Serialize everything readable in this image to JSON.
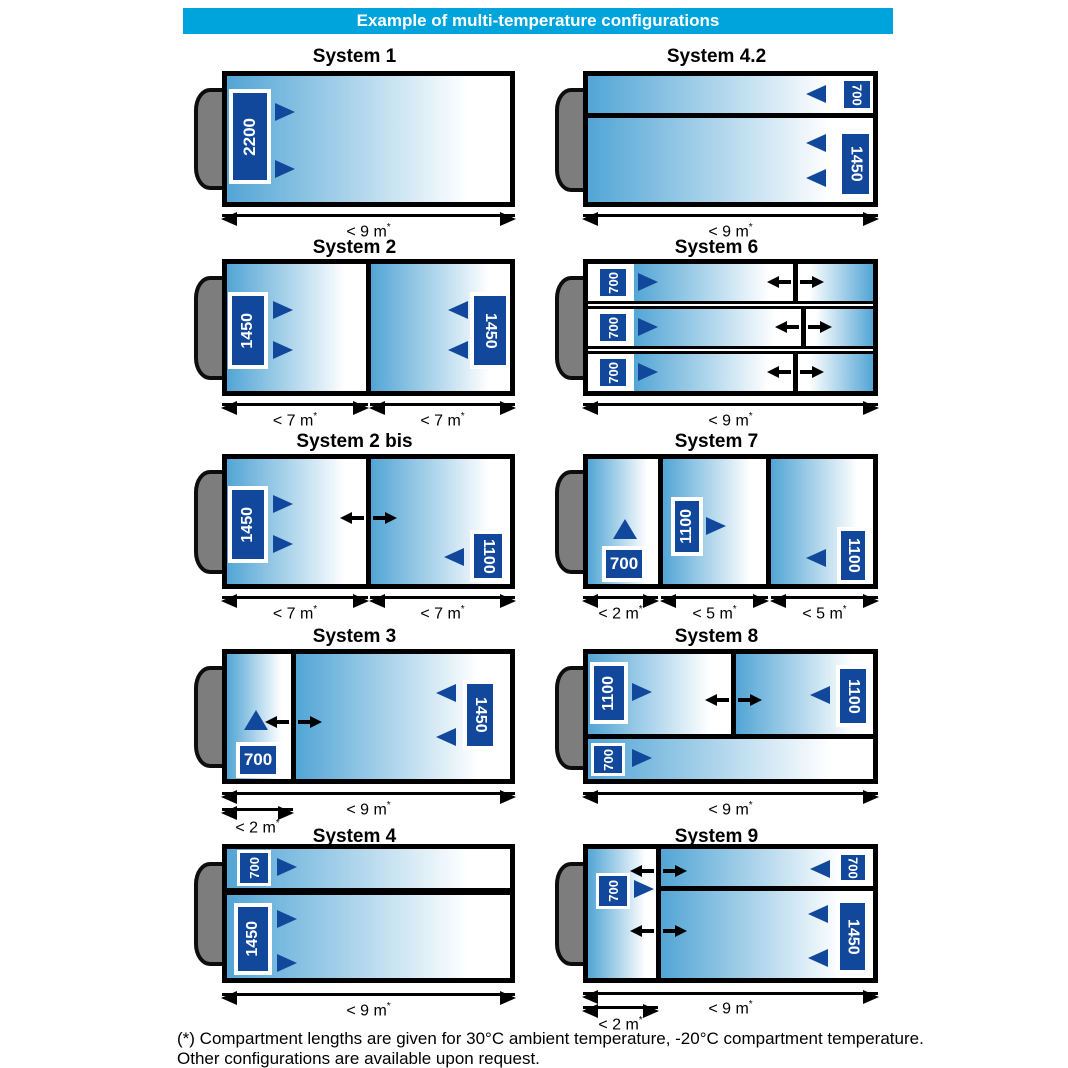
{
  "header": {
    "title": "Example of multi-temperature configurations"
  },
  "colors": {
    "header_bg": "#00a4dc",
    "unit_navy": "#11489c",
    "gradient_blue": "#52a5d5",
    "cab_gray": "#7d7d7d"
  },
  "systems": {
    "s1": {
      "title": "System 1",
      "unit": "2200",
      "dim": "< 9 m",
      "mark": "*"
    },
    "s42": {
      "title": "System 4.2",
      "unit_top": "700",
      "unit_bottom": "1450",
      "dim": "< 9 m",
      "mark": "*"
    },
    "s2": {
      "title": "System 2",
      "unit_left": "1450",
      "unit_right": "1450",
      "dim_left": "< 7 m",
      "dim_right": "< 7 m",
      "mark": "*"
    },
    "s6": {
      "title": "System 6",
      "unit_row1": "700",
      "unit_row2": "700",
      "unit_row3": "700",
      "dim": "< 9 m",
      "mark": "*"
    },
    "s2bis": {
      "title": "System 2 bis",
      "unit_left": "1450",
      "unit_right": "1100",
      "dim_left": "< 7 m",
      "dim_right": "< 7 m",
      "mark": "*"
    },
    "s7": {
      "title": "System 7",
      "unit_c1": "700",
      "unit_c2": "1100",
      "unit_c3": "1100",
      "dim_c1": "< 2 m",
      "dim_c2": "< 5 m",
      "dim_c3": "< 5 m",
      "mark": "*"
    },
    "s3": {
      "title": "System 3",
      "unit_c1": "700",
      "unit_c2": "1450",
      "dim_main": "< 9 m",
      "dim_c1": "< 2 m",
      "mark": "*"
    },
    "s8": {
      "title": "System 8",
      "unit_top_left": "1100",
      "unit_top_right": "1100",
      "unit_bottom": "700",
      "dim": "< 9 m",
      "mark": "*"
    },
    "s4": {
      "title": "System 4",
      "unit_top": "700",
      "unit_bottom": "1450",
      "dim": "< 9 m",
      "mark": "*"
    },
    "s9": {
      "title": "System 9",
      "unit_left": "700",
      "unit_top": "700",
      "unit_bottom": "1450",
      "dim_main": "< 9 m",
      "dim_left": "< 2 m",
      "mark": "*"
    }
  },
  "footnote": {
    "line1": "(*) Compartment lengths are given for 30°C ambient temperature, -20°C compartment temperature.",
    "line2": "Other configurations are available upon request."
  }
}
